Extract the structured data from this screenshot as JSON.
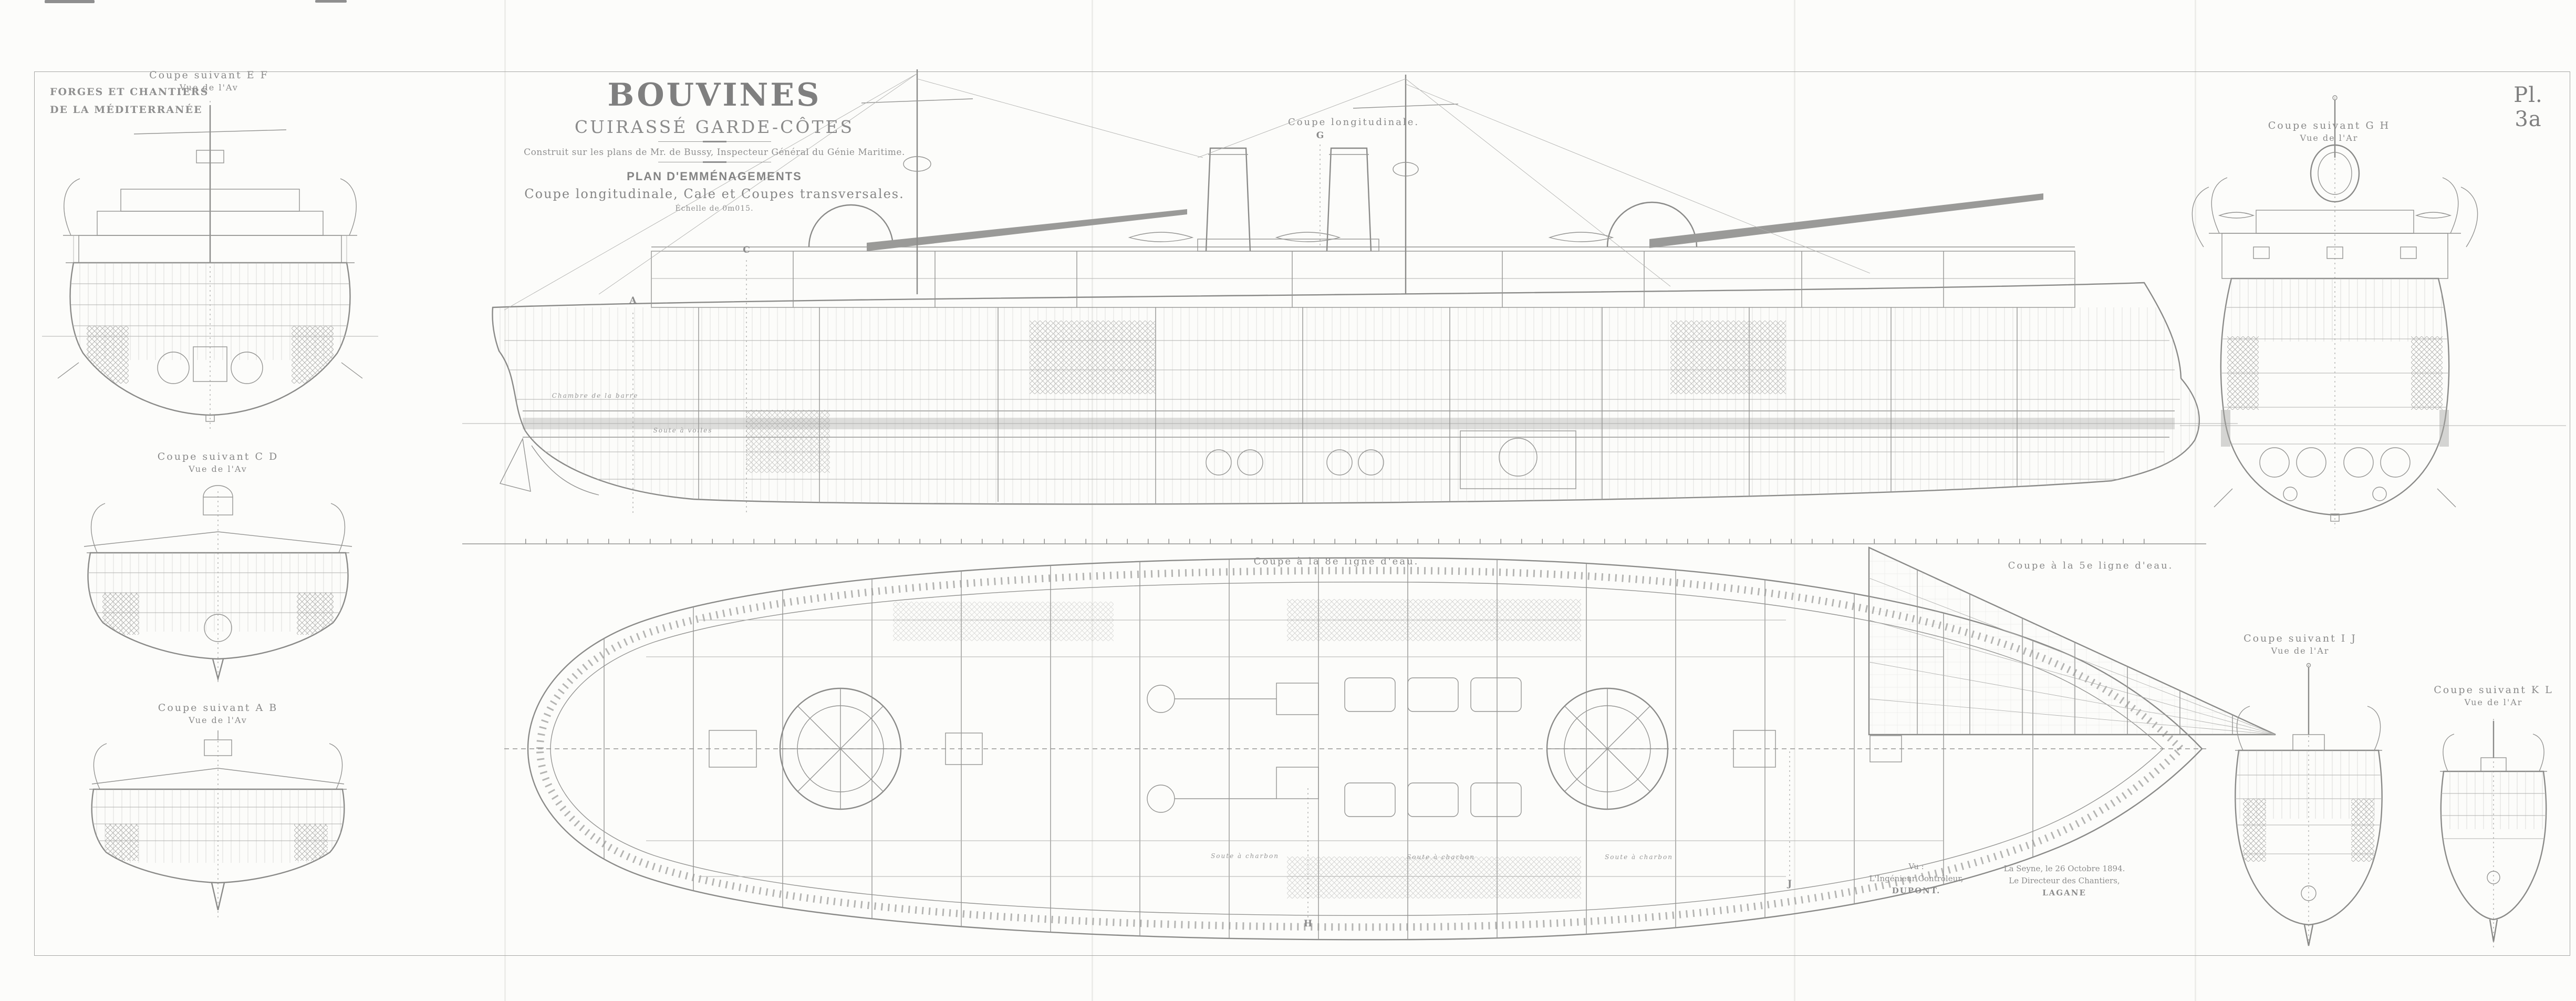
{
  "sheet": {
    "plate_number": "Pl. 3a",
    "builder_line1": "FORGES ET CHANTIERS",
    "builder_line2": "DE LA MÉDITERRANÉE",
    "title": "BOUVINES",
    "subtitle": "CUIRASSÉ GARDE-CÔTES",
    "attribution": "Construit sur les plans de Mr. de Bussy, Inspecteur Général du Génie Maritime.",
    "plan_heading": "PLAN D'EMMÉNAGEMENTS",
    "plan_subheading": "Coupe longitudinale, Cale et Coupes transversales.",
    "scale_note": "Échelle de 0m015."
  },
  "views": {
    "longitudinal": {
      "label": "Coupe longitudinale."
    },
    "hold_plan": {
      "label": "Coupe à la 8e ligne d'eau."
    },
    "waterline5": {
      "label": "Coupe à la 5e ligne d'eau."
    },
    "section_ef": {
      "label": "Coupe suivant E F",
      "view_from": "Vue de l'Av"
    },
    "section_cd": {
      "label": "Coupe suivant C D",
      "view_from": "Vue de l'Av"
    },
    "section_ab": {
      "label": "Coupe suivant A B",
      "view_from": "Vue de l'Av"
    },
    "section_gh": {
      "label": "Coupe suivant G H",
      "view_from": "Vue de l'Ar"
    },
    "section_ij": {
      "label": "Coupe suivant I J",
      "view_from": "Vue de l'Ar"
    },
    "section_kl": {
      "label": "Coupe suivant K L",
      "view_from": "Vue de l'Ar"
    }
  },
  "annotations": {
    "coal_bunker": "Soute à charbon",
    "steering_room": "Chambre de la barre",
    "sail_room": "Soute à voiles"
  },
  "markers": {
    "a": "A",
    "c": "C",
    "g": "G",
    "h": "H",
    "j": "J"
  },
  "signatures": {
    "left": {
      "line1": "Vu :",
      "line2": "L'Ingénieur Contrôleur,",
      "line3": "DUPONT."
    },
    "right": {
      "line1": "La Seyne, le 26 Octobre 1894.",
      "line2": "Le Directeur des Chantiers,",
      "line3": "LAGANE"
    }
  },
  "colors": {
    "ink": "#8a8a8a",
    "ink_dark": "#6f6f6f",
    "ink_light": "#b1b1af",
    "paper": "#fcfcfa"
  }
}
